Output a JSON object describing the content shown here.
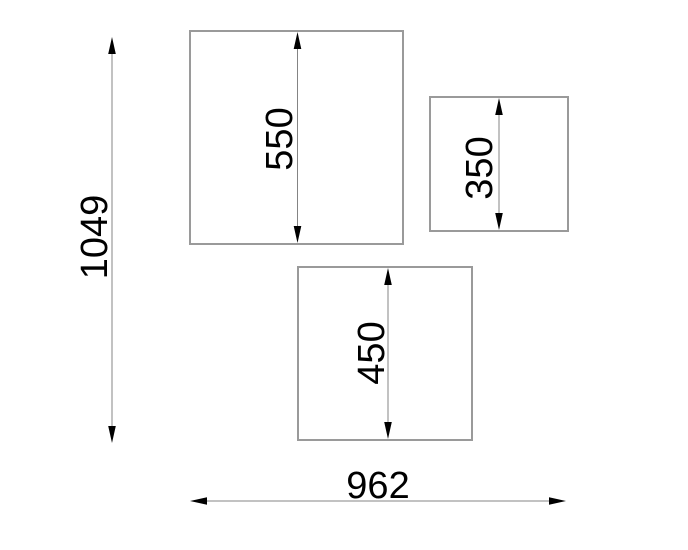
{
  "drawing": {
    "background_color": "#ffffff",
    "shape_outline_color": "#9a9a9a",
    "dimension_line_color": "#848484",
    "dimension_text_color": "#000000",
    "dimensions": {
      "overall_height": "1049",
      "overall_width": "962",
      "large_square_height": "550",
      "small_square_height": "350",
      "medium_square_height": "450"
    }
  }
}
